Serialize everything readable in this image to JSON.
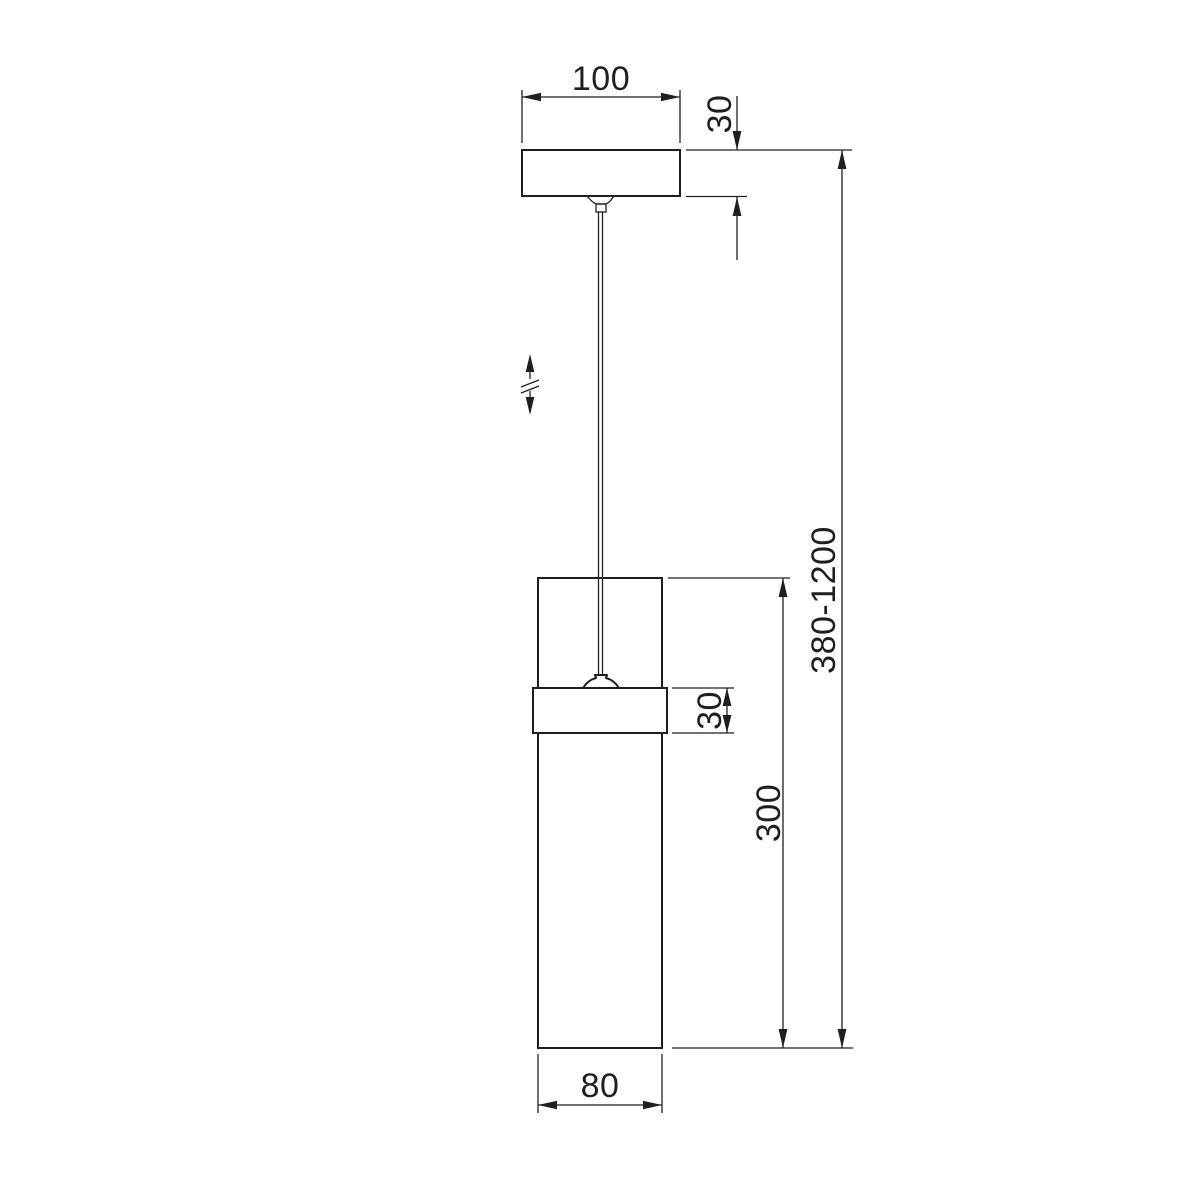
{
  "drawing": {
    "subject": "Pendant lamp technical dimension drawing",
    "background_color": "#ffffff",
    "line_color": "#1f1f1f",
    "labels": {
      "canopy_width": "100",
      "canopy_height": "30",
      "overall_height_range": "380-1200",
      "holder_height": "30",
      "shade_height": "300",
      "shade_diameter": "80"
    }
  }
}
